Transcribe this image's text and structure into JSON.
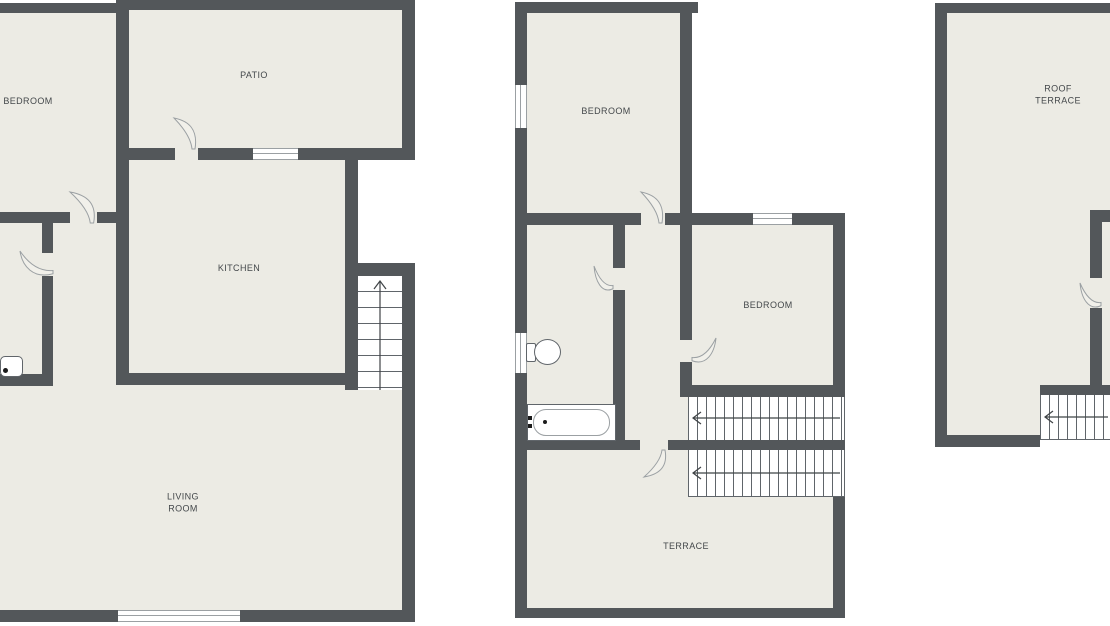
{
  "colors": {
    "background": "#FFFFFF",
    "wall": "#53575A",
    "floor": "#ECEBE4",
    "line": "#60656A",
    "thin": "#9BA0A3",
    "leaf": "#F1F0EA",
    "text": "#44484B"
  },
  "plans": [
    {
      "id": "first-floor",
      "rooms": [
        {
          "label": "BEDROOM"
        },
        {
          "label": "PATIO"
        },
        {
          "label": "KITCHEN"
        },
        {
          "label": "LIVING\nROOM"
        }
      ],
      "fixtures": [
        "sink"
      ],
      "stairs": [
        {
          "direction": "up"
        }
      ]
    },
    {
      "id": "second-floor",
      "rooms": [
        {
          "label": "BEDROOM"
        },
        {
          "label": "BEDROOM"
        },
        {
          "label": "TERRACE"
        }
      ],
      "fixtures": [
        "toilet",
        "bathtub"
      ],
      "stairs": [
        {
          "direction": "left"
        },
        {
          "direction": "left"
        }
      ]
    },
    {
      "id": "roof-floor",
      "rooms": [
        {
          "label": "ROOF\nTERRACE"
        }
      ],
      "fixtures": [],
      "stairs": [
        {
          "direction": "left"
        }
      ]
    }
  ]
}
